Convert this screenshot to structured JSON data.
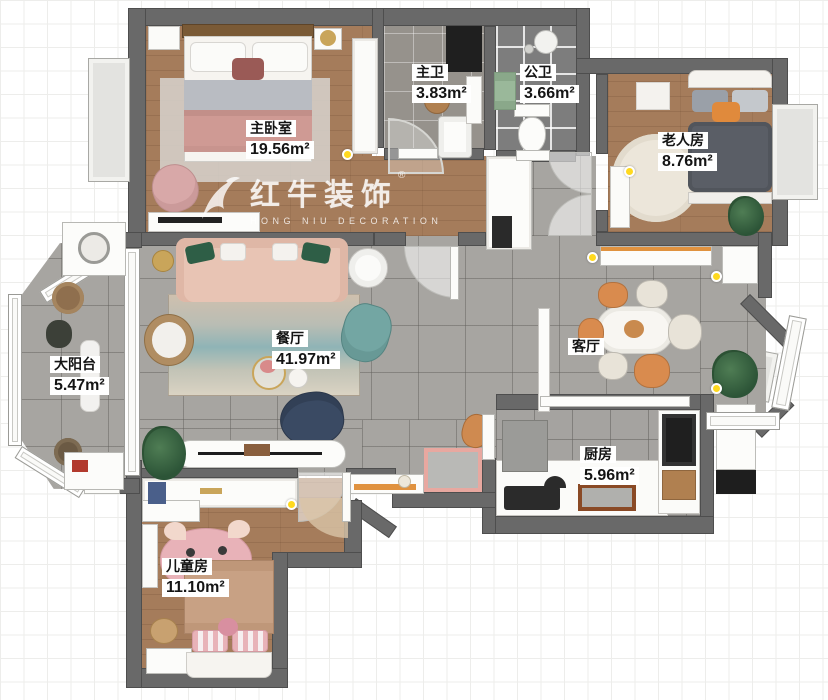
{
  "watermark": {
    "brand": "红牛装饰",
    "subtitle": "HONG NIU DECORATION",
    "registered": "®"
  },
  "rooms": [
    {
      "id": "master-bedroom",
      "label": "主卧室",
      "area": "19.56m²"
    },
    {
      "id": "master-bath",
      "label": "主卫",
      "area": "3.83m²"
    },
    {
      "id": "public-bath",
      "label": "公卫",
      "area": "3.66m²"
    },
    {
      "id": "elder-room",
      "label": "老人房",
      "area": "8.76m²"
    },
    {
      "id": "balcony",
      "label": "大阳台",
      "area": "5.47m²"
    },
    {
      "id": "dining-room",
      "label": "餐厅",
      "area": "41.97m²"
    },
    {
      "id": "living-room",
      "label": "客厅",
      "area": ""
    },
    {
      "id": "kitchen",
      "label": "厨房",
      "area": "5.96m²"
    },
    {
      "id": "kids-room",
      "label": "儿童房",
      "area": "11.10m²"
    }
  ],
  "colors": {
    "wall": "#696969",
    "wood": "#a57c5b",
    "tile_living": "#a7a5a1",
    "tile_bath_light": "#96928c",
    "tile_bath_dark": "#7d7d7d",
    "accent_orange": "#e0923f",
    "light_dot": "#ffd91f"
  }
}
